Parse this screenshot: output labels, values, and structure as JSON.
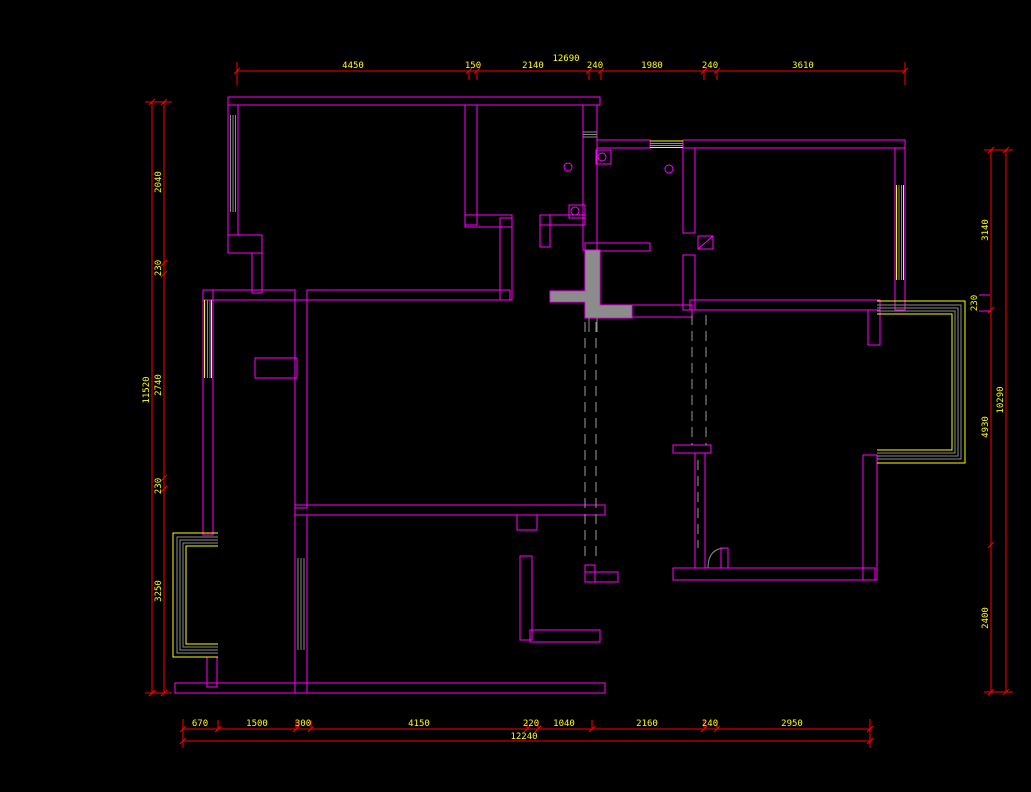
{
  "drawing": {
    "type": "cad-floor-plan",
    "background": "#000000"
  },
  "colors": {
    "wall": "#FF00FF",
    "dimension_line": "#FF0000",
    "dimension_text": "#FFFF00",
    "window_glazing": "#8C8C8C",
    "window_frame": "#FFFF00",
    "column_fill": "#8C8C8C"
  },
  "dims": {
    "top": {
      "overall": "12690",
      "segments": [
        "4450",
        "150",
        "2140",
        "240",
        "1980",
        "240",
        "3610"
      ]
    },
    "bottom": {
      "overall": "12240",
      "segments": [
        "670",
        "1500",
        "300",
        "4150",
        "220",
        "1040",
        "2160",
        "240",
        "2950"
      ]
    },
    "left": {
      "overall": "11520",
      "segments": [
        "2040",
        "230",
        "2740",
        "230",
        "3250"
      ]
    },
    "right": {
      "overall": "10290",
      "segments": [
        "3140",
        "4930",
        "2400"
      ],
      "bay_wall": "230"
    }
  }
}
